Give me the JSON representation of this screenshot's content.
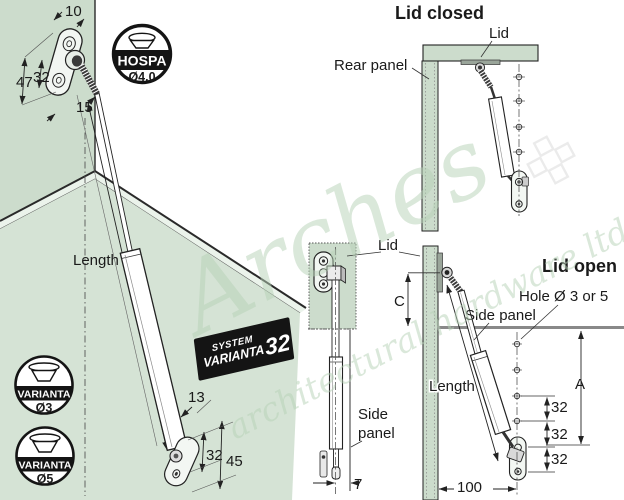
{
  "colors": {
    "panel_green": "#ccdccc",
    "floor_green": "#d5e3d5",
    "edge_light": "#ebf3eb",
    "line": "#222222",
    "thick_gray_line": "#898989",
    "badge_black": "#141414",
    "watermark_green": "#b7d2b7",
    "diamond_gray": "#d8d8d8"
  },
  "watermark": {
    "script_word": "Arches",
    "subtext": "architectural hardware ltd."
  },
  "iso_view": {
    "length_label": "Length",
    "dim_plate_width": "10",
    "dim_plate_height": "47",
    "dim_hole_spacing": "32",
    "dim_plate_bottom_width": "15",
    "dim_bracket_width": "13",
    "dim_bracket_hole_spacing": "32",
    "dim_bracket_height": "45",
    "hospa_badge": {
      "name": "HOSPA",
      "diameter": "Ø4.0"
    },
    "system_badge": {
      "line1": "SYSTEM",
      "line2": "VARIANTA",
      "number": "32"
    },
    "varianta3_badge": {
      "name": "VARIANTA",
      "size": "Ø3"
    },
    "varianta5_badge": {
      "name": "VARIANTA",
      "size": "Ø5"
    }
  },
  "lid_closed_view": {
    "title": "Lid closed",
    "lid_label": "Lid",
    "rear_panel_label": "Rear panel"
  },
  "front_view": {
    "lid_label": "Lid",
    "side_panel_label_line1": "Side",
    "side_panel_label_line2": "panel",
    "dim_offset": "7"
  },
  "lid_open_view": {
    "title": "Lid open",
    "hole_label": "Hole Ø 3 or 5",
    "side_panel_label": "Side panel",
    "length_label": "Length",
    "dim_c": "C",
    "dim_a": "A",
    "dim_spacing_1": "32",
    "dim_spacing_2": "32",
    "dim_spacing_3": "32",
    "dim_depth": "100"
  }
}
